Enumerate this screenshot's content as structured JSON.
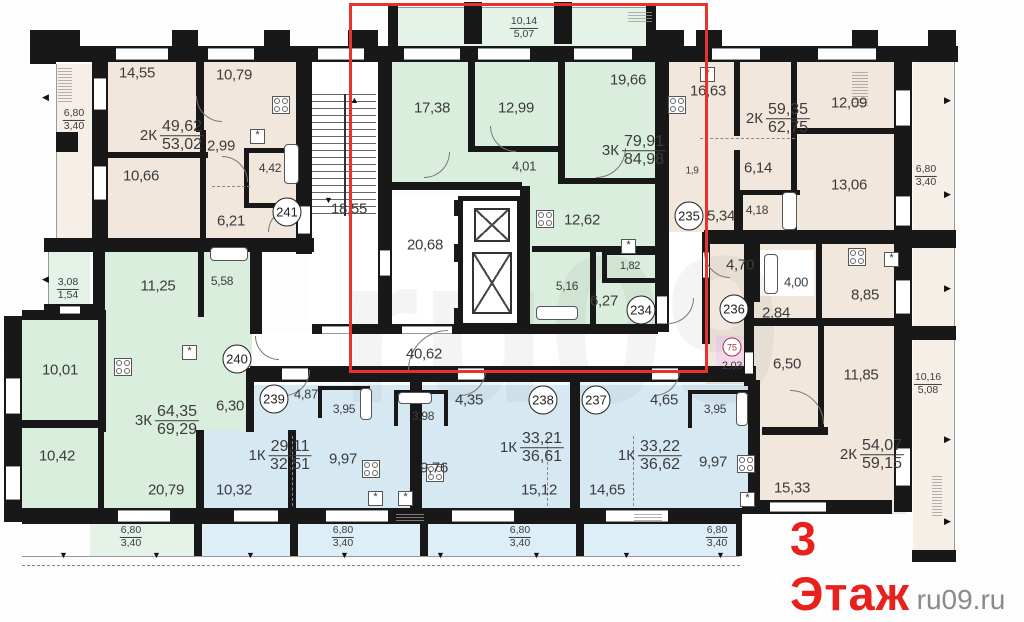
{
  "title": {
    "floor_label": "3 Этаж",
    "site_watermark": "ru09.ru",
    "faint_watermark": "ru09"
  },
  "colors": {
    "beige": "#f1e7dc",
    "beigeL": "#f6efe7",
    "mint": "#daeede",
    "mintL": "#e4f2e7",
    "blue": "#d6e9f3",
    "blueL": "#ddeef7",
    "pink": "#f2d8ea",
    "white": "#ffffff",
    "wall": "#181818",
    "red_box": "#e8322c",
    "red_text": "#e8211d",
    "text": "#3c3c3c"
  },
  "apartments": [
    {
      "badge": "241",
      "type": "2К",
      "area_living": "49,62",
      "area_total": "53,02"
    },
    {
      "badge": "234",
      "type": "3К",
      "area_living": "79,91",
      "area_total": "84,98"
    },
    {
      "badge": "235",
      "type": "2К",
      "area_living": "59,35",
      "area_total": "62,75"
    },
    {
      "badge": "240",
      "type": "3К",
      "area_living": "64,35",
      "area_total": "69,29"
    },
    {
      "badge": "239",
      "type": "1К",
      "area_living": "29,11",
      "area_total": "32,51"
    },
    {
      "badge": "238",
      "type": "1К",
      "area_living": "33,21",
      "area_total": "36,61"
    },
    {
      "badge": "237",
      "type": "1К",
      "area_living": "33,22",
      "area_total": "36,62"
    },
    {
      "badge": "",
      "type": "2К",
      "area_living": "54,07",
      "area_total": "59,15"
    }
  ],
  "rooms": [
    [
      95,
      62,
      215,
      178,
      "beige"
    ],
    [
      660,
      62,
      245,
      170,
      "beige"
    ],
    [
      706,
      244,
      200,
      140,
      "beige"
    ],
    [
      750,
      318,
      156,
      196,
      "beige"
    ],
    [
      56,
      64,
      38,
      176,
      "beigeL"
    ],
    [
      913,
      62,
      42,
      176,
      "beigeL"
    ],
    [
      913,
      248,
      42,
      308,
      "beigeL"
    ],
    [
      392,
      62,
      263,
      122,
      "mint"
    ],
    [
      460,
      148,
      102,
      38,
      "mint"
    ],
    [
      528,
      182,
      127,
      150,
      "mint"
    ],
    [
      95,
      245,
      157,
      187,
      "mint"
    ],
    [
      22,
      314,
      80,
      200,
      "mint"
    ],
    [
      100,
      430,
      96,
      84,
      "mint"
    ],
    [
      396,
      8,
      256,
      38,
      "mintL"
    ],
    [
      48,
      250,
      42,
      60,
      "mintL"
    ],
    [
      90,
      524,
      106,
      32,
      "mintL"
    ],
    [
      252,
      385,
      170,
      45,
      "blue"
    ],
    [
      200,
      430,
      222,
      84,
      "blue"
    ],
    [
      422,
      385,
      157,
      129,
      "blue"
    ],
    [
      579,
      385,
      171,
      129,
      "blue"
    ],
    [
      200,
      524,
      92,
      32,
      "blueL"
    ],
    [
      296,
      524,
      126,
      32,
      "blueL"
    ],
    [
      426,
      524,
      150,
      32,
      "blueL"
    ],
    [
      580,
      524,
      158,
      32,
      "blueL"
    ],
    [
      716,
      336,
      32,
      38,
      "pink"
    ],
    [
      310,
      62,
      68,
      262,
      "white"
    ],
    [
      392,
      196,
      68,
      134,
      "white"
    ],
    [
      252,
      332,
      452,
      34,
      "white"
    ],
    [
      668,
      232,
      36,
      100,
      "white"
    ],
    [
      758,
      250,
      56,
      46,
      "white"
    ],
    [
      0,
      352,
      18,
      52,
      "white"
    ]
  ],
  "walls": [
    [
      54,
      46,
      904,
      16
    ],
    [
      54,
      30,
      26,
      18
    ],
    [
      172,
      30,
      26,
      18
    ],
    [
      264,
      30,
      26,
      18
    ],
    [
      348,
      30,
      30,
      18
    ],
    [
      654,
      30,
      30,
      18
    ],
    [
      696,
      30,
      26,
      18
    ],
    [
      852,
      30,
      26,
      18
    ],
    [
      928,
      30,
      28,
      18
    ],
    [
      388,
      4,
      10,
      42
    ],
    [
      646,
      4,
      10,
      42
    ],
    [
      464,
      2,
      18,
      42
    ],
    [
      554,
      2,
      18,
      42
    ],
    [
      30,
      30,
      26,
      34
    ],
    [
      92,
      62,
      16,
      178
    ],
    [
      56,
      132,
      22,
      20
    ],
    [
      44,
      238,
      54,
      14
    ],
    [
      92,
      238,
      222,
      14
    ],
    [
      44,
      304,
      52,
      12
    ],
    [
      4,
      316,
      18,
      198
    ],
    [
      22,
      310,
      80,
      10
    ],
    [
      196,
      62,
      8,
      70
    ],
    [
      108,
      152,
      100,
      6
    ],
    [
      200,
      130,
      6,
      110
    ],
    [
      296,
      62,
      16,
      192
    ],
    [
      22,
      420,
      78,
      8
    ],
    [
      98,
      310,
      8,
      122
    ],
    [
      93,
      245,
      12,
      72
    ],
    [
      198,
      245,
      6,
      72
    ],
    [
      250,
      238,
      12,
      96
    ],
    [
      98,
      430,
      6,
      84
    ],
    [
      196,
      430,
      8,
      84
    ],
    [
      288,
      430,
      8,
      84
    ],
    [
      378,
      62,
      14,
      264
    ],
    [
      468,
      62,
      7,
      90
    ],
    [
      558,
      62,
      7,
      122
    ],
    [
      392,
      182,
      130,
      8
    ],
    [
      472,
      146,
      92,
      6
    ],
    [
      560,
      178,
      95,
      6
    ],
    [
      520,
      186,
      10,
      146
    ],
    [
      532,
      246,
      123,
      6
    ],
    [
      590,
      252,
      6,
      80
    ],
    [
      655,
      62,
      14,
      270
    ],
    [
      702,
      232,
      8,
      112
    ],
    [
      312,
      324,
      346,
      10
    ],
    [
      250,
      366,
      458,
      16
    ],
    [
      700,
      366,
      56,
      16
    ],
    [
      655,
      230,
      13,
      14
    ],
    [
      704,
      230,
      201,
      14
    ],
    [
      734,
      62,
      6,
      74
    ],
    [
      791,
      62,
      6,
      74
    ],
    [
      795,
      128,
      110,
      6
    ],
    [
      791,
      134,
      6,
      96
    ],
    [
      734,
      150,
      6,
      80
    ],
    [
      754,
      244,
      6,
      58
    ],
    [
      816,
      244,
      6,
      76
    ],
    [
      744,
      232,
      10,
      154
    ],
    [
      750,
      318,
      156,
      8
    ],
    [
      818,
      326,
      6,
      102
    ],
    [
      748,
      380,
      12,
      134
    ],
    [
      762,
      427,
      66,
      8
    ],
    [
      410,
      368,
      12,
      146
    ],
    [
      570,
      368,
      10,
      146
    ],
    [
      246,
      368,
      8,
      64
    ],
    [
      22,
      508,
      720,
      16
    ],
    [
      742,
      500,
      150,
      14
    ],
    [
      894,
      62,
      18,
      450
    ],
    [
      912,
      230,
      44,
      18
    ],
    [
      912,
      326,
      44,
      14
    ],
    [
      912,
      550,
      44,
      12
    ],
    [
      738,
      190,
      5,
      44
    ],
    [
      738,
      190,
      62,
      5
    ],
    [
      244,
      148,
      5,
      60
    ],
    [
      244,
      148,
      58,
      5
    ],
    [
      244,
      203,
      58,
      5
    ],
    [
      602,
      250,
      54,
      5
    ],
    [
      602,
      250,
      5,
      30
    ],
    [
      602,
      278,
      54,
      5
    ],
    [
      454,
      200,
      8,
      16
    ],
    [
      454,
      244,
      8,
      18
    ],
    [
      454,
      308,
      8,
      18
    ],
    [
      194,
      524,
      8,
      32
    ],
    [
      290,
      524,
      8,
      32
    ],
    [
      420,
      524,
      8,
      32
    ],
    [
      576,
      524,
      8,
      32
    ],
    [
      736,
      524,
      6,
      32
    ],
    [
      4,
      500,
      18,
      22
    ],
    [
      318,
      386,
      52,
      4
    ],
    [
      318,
      386,
      4,
      32
    ],
    [
      366,
      386,
      4,
      32
    ],
    [
      394,
      390,
      54,
      4
    ],
    [
      394,
      390,
      4,
      36
    ],
    [
      444,
      390,
      4,
      36
    ],
    [
      688,
      390,
      62,
      4
    ],
    [
      688,
      390,
      4,
      38
    ]
  ],
  "windows": [
    [
      116,
      48,
      52,
      12
    ],
    [
      208,
      48,
      46,
      12
    ],
    [
      318,
      48,
      46,
      12
    ],
    [
      404,
      48,
      56,
      12
    ],
    [
      478,
      48,
      52,
      12
    ],
    [
      574,
      48,
      58,
      12
    ],
    [
      712,
      48,
      48,
      12
    ],
    [
      818,
      48,
      58,
      12
    ],
    [
      94,
      78,
      12,
      32
    ],
    [
      94,
      166,
      12,
      34
    ],
    [
      6,
      378,
      14,
      36
    ],
    [
      6,
      466,
      14,
      34
    ],
    [
      118,
      510,
      52,
      12
    ],
    [
      234,
      510,
      44,
      12
    ],
    [
      326,
      510,
      62,
      12
    ],
    [
      452,
      510,
      62,
      12
    ],
    [
      606,
      510,
      62,
      12
    ],
    [
      770,
      502,
      56,
      10
    ],
    [
      896,
      90,
      14,
      36
    ],
    [
      896,
      196,
      14,
      30
    ],
    [
      896,
      280,
      14,
      34
    ],
    [
      896,
      448,
      14,
      38
    ],
    [
      298,
      206,
      12,
      28
    ],
    [
      380,
      250,
      10,
      26
    ],
    [
      657,
      296,
      10,
      28
    ],
    [
      703,
      252,
      6,
      26
    ],
    [
      745,
      352,
      8,
      22
    ],
    [
      282,
      368,
      26,
      12
    ],
    [
      458,
      368,
      26,
      12
    ],
    [
      652,
      368,
      26,
      12
    ],
    [
      402,
      326,
      50,
      8
    ],
    [
      322,
      326,
      30,
      8
    ],
    [
      60,
      306,
      20,
      8
    ]
  ],
  "thin_lines": [
    [
      56,
      64,
      1,
      176
    ],
    [
      954,
      62,
      1,
      494
    ],
    [
      90,
      556,
      650,
      1
    ],
    [
      396,
      7,
      256,
      1
    ],
    [
      48,
      250,
      1,
      62
    ],
    [
      22,
      556,
      70,
      1
    ]
  ],
  "labels": [
    [
      "14,55",
      137,
      73,
      15
    ],
    [
      "10,79",
      234,
      75,
      15
    ],
    [
      "2,99",
      221,
      146,
      15
    ],
    [
      "10,66",
      141,
      176,
      15
    ],
    [
      "4,42",
      270,
      168,
      12
    ],
    [
      "6,21",
      231,
      221,
      15
    ],
    [
      "17,38",
      432,
      108,
      15
    ],
    [
      "12,99",
      516,
      108,
      15
    ],
    [
      "19,66",
      628,
      80,
      15
    ],
    [
      "4,01",
      524,
      166,
      13
    ],
    [
      "18,55",
      349,
      209,
      15
    ],
    [
      "20,68",
      425,
      245,
      15
    ],
    [
      "12,62",
      582,
      220,
      15
    ],
    [
      "5,16",
      567,
      286,
      12
    ],
    [
      "1,82",
      630,
      266,
      11
    ],
    [
      "6,27",
      604,
      301,
      15
    ],
    [
      "40,62",
      424,
      354,
      15
    ],
    [
      "16,63",
      708,
      91,
      15
    ],
    [
      "12,09",
      849,
      103,
      15
    ],
    [
      "6,14",
      758,
      168,
      15
    ],
    [
      "13,06",
      849,
      185,
      15
    ],
    [
      "4,18",
      757,
      210,
      12
    ],
    [
      "5,34",
      721,
      216,
      15
    ],
    [
      "1,9",
      692,
      171,
      10
    ],
    [
      "4,70",
      740,
      265,
      15
    ],
    [
      "4,00",
      796,
      282,
      13
    ],
    [
      "8,85",
      865,
      295,
      15
    ],
    [
      "2,84",
      776,
      313,
      15
    ],
    [
      "2,03",
      732,
      366,
      11
    ],
    [
      "6,50",
      787,
      364,
      15
    ],
    [
      "11,85",
      861,
      375,
      15
    ],
    [
      "11,25",
      158,
      286,
      15
    ],
    [
      "5,58",
      222,
      281,
      12
    ],
    [
      "10,01",
      60,
      370,
      15
    ],
    [
      "6,30",
      230,
      406,
      15
    ],
    [
      "10,42",
      57,
      456,
      15
    ],
    [
      "20,79",
      166,
      490,
      15
    ],
    [
      "4,87",
      306,
      394,
      13
    ],
    [
      "3,95",
      344,
      409,
      12
    ],
    [
      "9,97",
      343,
      459,
      15
    ],
    [
      "10,32",
      234,
      490,
      15
    ],
    [
      "3,98",
      423,
      416,
      12
    ],
    [
      "4,35",
      469,
      400,
      15
    ],
    [
      "9,76",
      434,
      468,
      15
    ],
    [
      "15,12",
      539,
      490,
      15
    ],
    [
      "4,65",
      664,
      400,
      15
    ],
    [
      "3,95",
      715,
      409,
      12
    ],
    [
      "14,65",
      607,
      490,
      15
    ],
    [
      "9,97",
      713,
      462,
      15
    ],
    [
      "15,33",
      792,
      488,
      15
    ]
  ],
  "apartment_fracs": [
    [
      "2К",
      "49,62",
      "53,02",
      172,
      136
    ],
    [
      "3К",
      "79,91",
      "84,98",
      634,
      151
    ],
    [
      "2К",
      "59,35",
      "62,75",
      778,
      119
    ],
    [
      "3К",
      "64,35",
      "69,29",
      167,
      421
    ],
    [
      "1К",
      "29,11",
      "32,51",
      280,
      456
    ],
    [
      "1К",
      "33,21",
      "36,61",
      532,
      448
    ],
    [
      "1К",
      "33,22",
      "36,62",
      650,
      456
    ],
    [
      "2К",
      "54,07",
      "59,15",
      872,
      455
    ]
  ],
  "balcony_fracs": [
    [
      "6,80",
      "3,40",
      74,
      120
    ],
    [
      "10,14",
      "5,07",
      524,
      28
    ],
    [
      "6,80",
      "3,40",
      926,
      176
    ],
    [
      "3,08",
      "1,54",
      68,
      289
    ],
    [
      "10,16",
      "5,08",
      928,
      384
    ],
    [
      "6,80",
      "3,40",
      131,
      537
    ],
    [
      "6,80",
      "3,40",
      343,
      537
    ],
    [
      "6,80",
      "3,40",
      520,
      537
    ],
    [
      "6,80",
      "3,40",
      717,
      537
    ]
  ],
  "badges": [
    [
      "241",
      287,
      212
    ],
    [
      "240",
      237,
      359
    ],
    [
      "239",
      274,
      399
    ],
    [
      "238",
      543,
      400
    ],
    [
      "237",
      596,
      400
    ],
    [
      "236",
      734,
      309
    ],
    [
      "235",
      689,
      216
    ],
    [
      "234",
      641,
      310
    ]
  ],
  "small_badge": [
    "75",
    732,
    347
  ],
  "stoves": [
    [
      272,
      96
    ],
    [
      668,
      96
    ],
    [
      536,
      210
    ],
    [
      848,
      248
    ],
    [
      114,
      358
    ],
    [
      362,
      460
    ],
    [
      426,
      464
    ],
    [
      737,
      455
    ]
  ],
  "tubs": [
    [
      284,
      144,
      15,
      40
    ],
    [
      782,
      192,
      15,
      38
    ],
    [
      536,
      306,
      42,
      14
    ],
    [
      210,
      247,
      38,
      14
    ],
    [
      764,
      254,
      14,
      40
    ],
    [
      360,
      388,
      12,
      32
    ],
    [
      398,
      392,
      34,
      12
    ],
    [
      736,
      392,
      12,
      34
    ]
  ],
  "stars": [
    [
      250,
      129
    ],
    [
      700,
      67
    ],
    [
      621,
      239
    ],
    [
      884,
      252
    ],
    [
      182,
      345
    ],
    [
      368,
      491
    ],
    [
      398,
      491
    ],
    [
      740,
      492
    ]
  ],
  "arcs": [
    [
      196,
      96,
      26,
      "bl"
    ],
    [
      222,
      156,
      26,
      "tr"
    ],
    [
      268,
      208,
      24,
      "tl"
    ],
    [
      424,
      152,
      26,
      "br"
    ],
    [
      490,
      126,
      26,
      "bl"
    ],
    [
      596,
      148,
      30,
      "br"
    ],
    [
      408,
      330,
      40,
      "tl"
    ],
    [
      284,
      370,
      26,
      "br"
    ],
    [
      460,
      370,
      26,
      "br"
    ],
    [
      654,
      370,
      26,
      "br"
    ],
    [
      668,
      298,
      26,
      "br"
    ],
    [
      704,
      252,
      26,
      "bl"
    ],
    [
      790,
      390,
      34,
      "tr"
    ],
    [
      255,
      336,
      24,
      "bl"
    ]
  ],
  "dashes": [
    [
      212,
      186,
      38,
      "h"
    ],
    [
      700,
      138,
      95,
      "h"
    ],
    [
      292,
      436,
      70,
      "v"
    ],
    [
      547,
      436,
      70,
      "v"
    ],
    [
      633,
      436,
      70,
      "v"
    ],
    [
      22,
      565,
      718,
      "h"
    ]
  ],
  "arrows_down_y": 551,
  "arrows_down_x": [
    59,
    152,
    246,
    340,
    436,
    532,
    622,
    716
  ],
  "arrows_left": [
    [
      42,
      93
    ],
    [
      42,
      275
    ]
  ],
  "arrows_right": [
    [
      944,
      96
    ],
    [
      944,
      190
    ],
    [
      944,
      284
    ],
    [
      944,
      435
    ],
    [
      944,
      517
    ]
  ],
  "stair_arrows": {
    "up": [
      350,
      96
    ],
    "down": [
      324,
      196
    ]
  },
  "tiny_blocks": [
    [
      58,
      66,
      14,
      36
    ],
    [
      852,
      72,
      16,
      34
    ],
    [
      628,
      12,
      24,
      10
    ],
    [
      932,
      476,
      10,
      40
    ],
    [
      396,
      513,
      28,
      8
    ],
    [
      634,
      513,
      28,
      8
    ]
  ],
  "stairs_rect": [
    312,
    94,
    64,
    122
  ],
  "elevator": {
    "shaft": [
      458,
      196,
      64,
      132
    ],
    "cars": [
      [
        474,
        208,
        36,
        34
      ],
      [
        472,
        252,
        40,
        62
      ]
    ]
  },
  "red_box": [
    349,
    3,
    353,
    364
  ]
}
